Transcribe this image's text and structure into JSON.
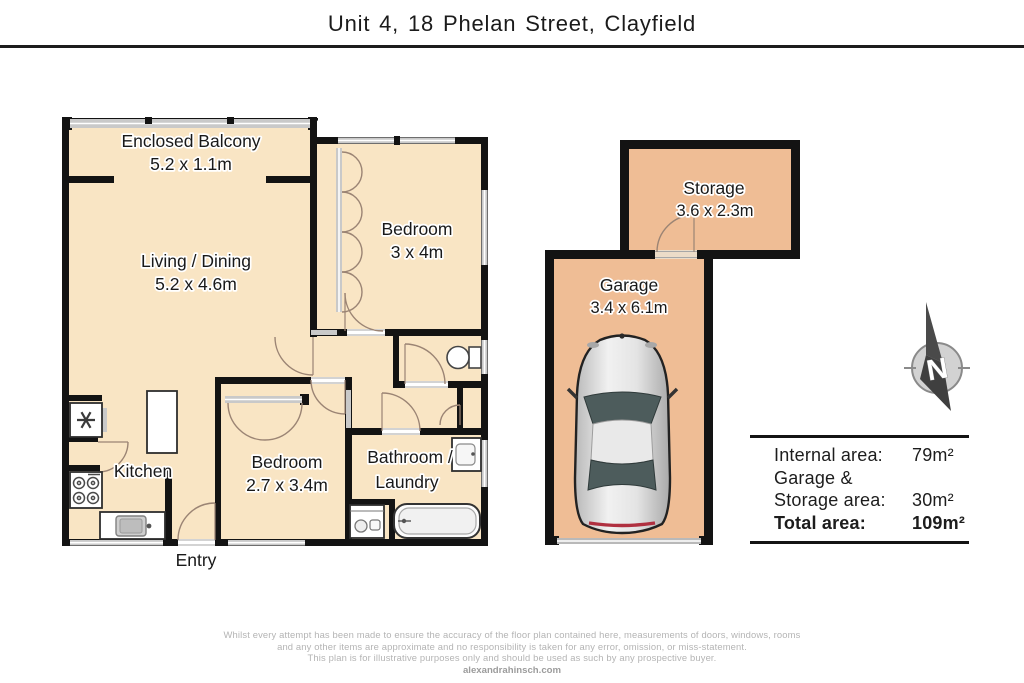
{
  "header": {
    "title": "Unit 4, 18 Phelan Street, Clayfield"
  },
  "plan": {
    "rooms": {
      "balcony": {
        "name": "Enclosed Balcony",
        "dims": "5.2 x 1.1m"
      },
      "living": {
        "name": "Living / Dining",
        "dims": "5.2 x 4.6m"
      },
      "bedroom1": {
        "name": "Bedroom",
        "dims": "3 x 4m"
      },
      "kitchen": {
        "name": "Kitchen"
      },
      "bedroom2": {
        "name": "Bedroom",
        "dims": "2.7 x 3.4m"
      },
      "bathroom": {
        "line1": "Bathroom /",
        "line2": "Laundry"
      },
      "entry": {
        "name": "Entry"
      },
      "storage": {
        "name": "Storage",
        "dims": "3.6 x 2.3m"
      },
      "garage": {
        "name": "Garage",
        "dims": "3.4 x 6.1m"
      }
    },
    "compass": {
      "letter": "N"
    }
  },
  "areas": {
    "internal_label": "Internal area:",
    "internal_value": "79m²",
    "garage_label_line1": "Garage &",
    "garage_label_line2": "Storage area:",
    "garage_storage_value": "30m²",
    "total_label": "Total area:",
    "total_value": "109m²"
  },
  "footer": {
    "disclaimer_line1": "Whilst every attempt has been made to ensure the accuracy of the floor plan contained here, measurements of doors, windows, rooms",
    "disclaimer_line2": "and any other items are approximate and no responsibility is taken for any error, omission, or miss-statement.",
    "disclaimer_line3": "This plan is for illustrative purposes only and should be used as such by any prospective buyer.",
    "website": "alexandrahinsch.com"
  },
  "colors": {
    "floor_interior": "#F9E5C4",
    "floor_garage_storage": "#EFBD95",
    "wall": "#131313",
    "window": "#C9C9C9",
    "door_arc": "#9B8474",
    "car_glass": "#4D5C5C",
    "tail_light": "#B03040"
  }
}
